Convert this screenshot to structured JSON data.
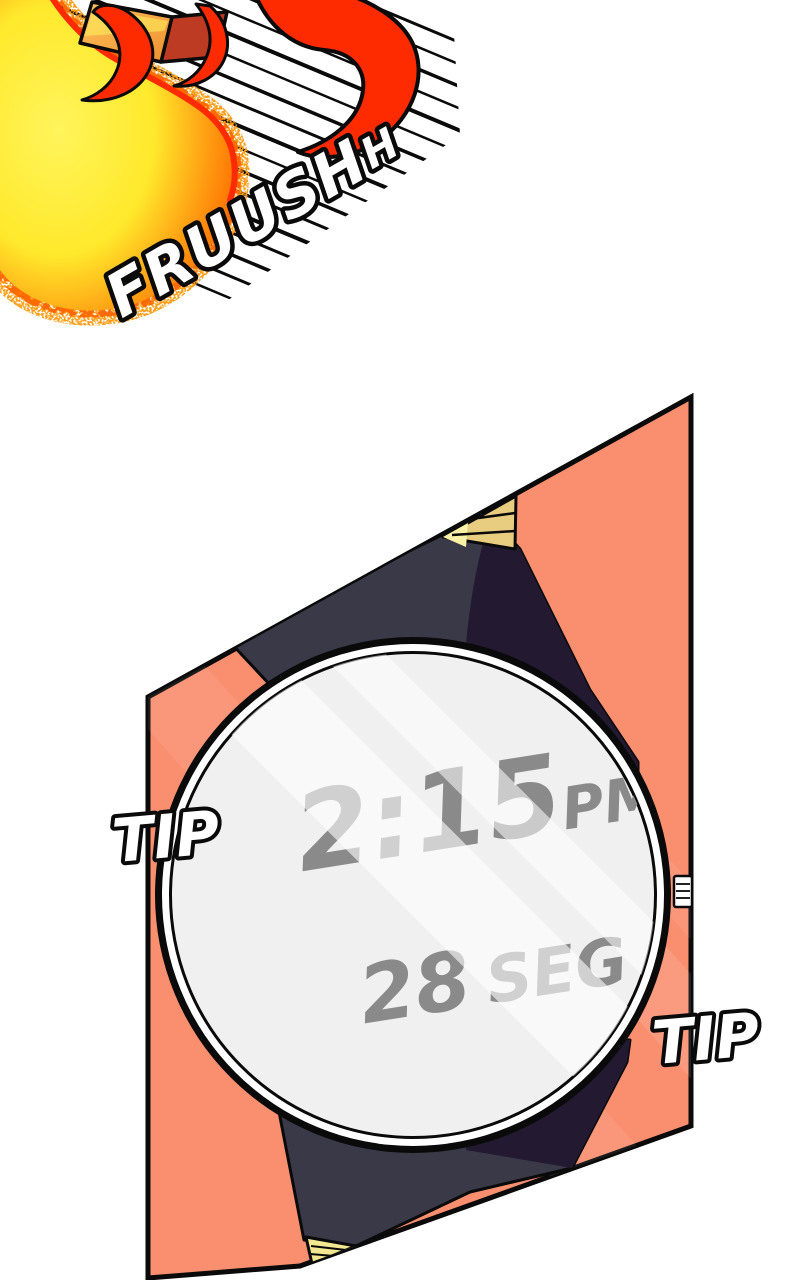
{
  "sfx": {
    "whoosh": {
      "main": "FRUUSH",
      "tail": "H"
    },
    "tip_left": "TIP",
    "tip_right": "TIP"
  },
  "watch_display": {
    "time": "2:15",
    "meridiem": "PM",
    "seconds": "28",
    "seconds_unit": "SEG"
  },
  "colors": {
    "ink": "#0a0a0a",
    "paper": "#ffffff",
    "salmon": "#fa8f70",
    "salmon_sheen": "#ffb193",
    "band_light": "#3a3948",
    "band_dark": "#231a31",
    "gold": "#e8cc7f",
    "gold_light": "#f9f2a6",
    "gold_bottom": "#f3e88f",
    "face_gray": "#f0f0f0",
    "time_gray": "#8a8a8a",
    "flame_yellow_bright": "#fff45c",
    "flame_yellow": "#ffe92c",
    "flame_orange": "#ff9d12",
    "flame_deep": "#ff6a00",
    "flame_red": "#ff2b00",
    "box_orange_hi": "#ffc35c",
    "box_orange_lo": "#ee8f2f",
    "box_side": "#bc3b22"
  }
}
